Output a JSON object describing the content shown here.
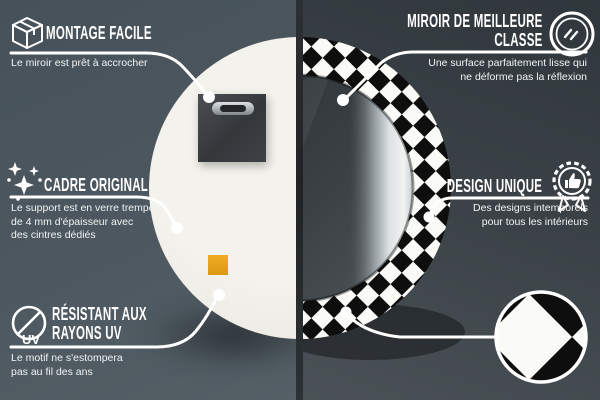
{
  "canvas": {
    "width": 600,
    "height": 400
  },
  "colors": {
    "bg_left_top": "#46515a",
    "bg_left_bottom": "#545f66",
    "bg_right_top": "#30373c",
    "bg_right_bottom": "#4b5257",
    "divider": "#1f2326",
    "line_white": "#ffffff",
    "mirror_back": "#efede7",
    "mounting_plate": "#3a3e41",
    "sticker_orange": "#e8a41f",
    "checker_black": "#0e0e0e",
    "checker_white": "#fafaf7",
    "glass_dark": "#2c3135",
    "glass_light_strip": "#eef0f1"
  },
  "callouts": {
    "montage": {
      "icon": "package-box-icon",
      "title": "MONTAGE FACILE",
      "desc": "Le miroir est prêt à accrocher"
    },
    "cadre": {
      "icon": "sparkles-icon",
      "title": "CADRE ORIGINAL",
      "desc": "Le support est en verre trempé\nde 4 mm d'épaisseur avec\ndes cintres dédiés"
    },
    "uv": {
      "icon": "uv-resistant-icon",
      "icon_label": "UV",
      "title": "RÉSISTANT AUX\nRAYONS UV",
      "desc": "Le motif ne s'estompera\npas au fil des ans"
    },
    "miroir": {
      "icon": "mirror-icon",
      "title": "MIROIR DE MEILLEURE\nCLASSE",
      "desc": "Une surface parfaitement lisse qui\nne déforme pas la réflexion"
    },
    "design": {
      "icon": "award-badge-icon",
      "title": "DESIGN UNIQUE",
      "desc": "Des designs intemporels\npour tous les intérieurs"
    }
  }
}
